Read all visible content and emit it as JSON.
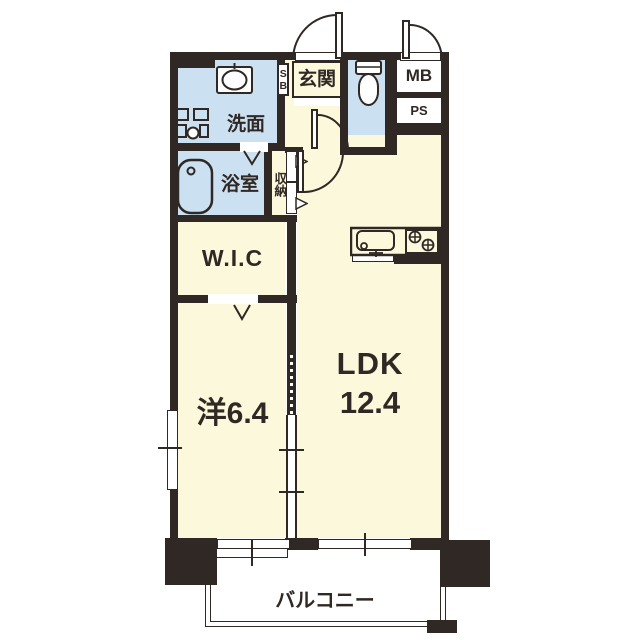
{
  "plan": {
    "rooms": {
      "entrance": "玄関",
      "shoe_box": "SB",
      "washroom": "洗面",
      "bathroom": "浴室",
      "storage": "収納",
      "wic": "W.I.C",
      "bedroom": "洋6.4",
      "ldk_name": "LDK",
      "ldk_size": "12.4",
      "meter_box": "MB",
      "pipe_space": "PS",
      "balcony": "バルコニー"
    },
    "colors": {
      "wall": "#2f2824",
      "wet_room_fill": "#cbe0f0",
      "room_fill": "#fcf8dc",
      "background": "#ffffff"
    },
    "icons": {
      "washing_machine": "washing-machine-icon",
      "vanity_sink": "vanity-sink-icon",
      "bathtub": "bathtub-icon",
      "toilet": "toilet-icon",
      "kitchen_sink": "kitchen-sink-icon",
      "gas_stove": "gas-stove-icon"
    }
  }
}
